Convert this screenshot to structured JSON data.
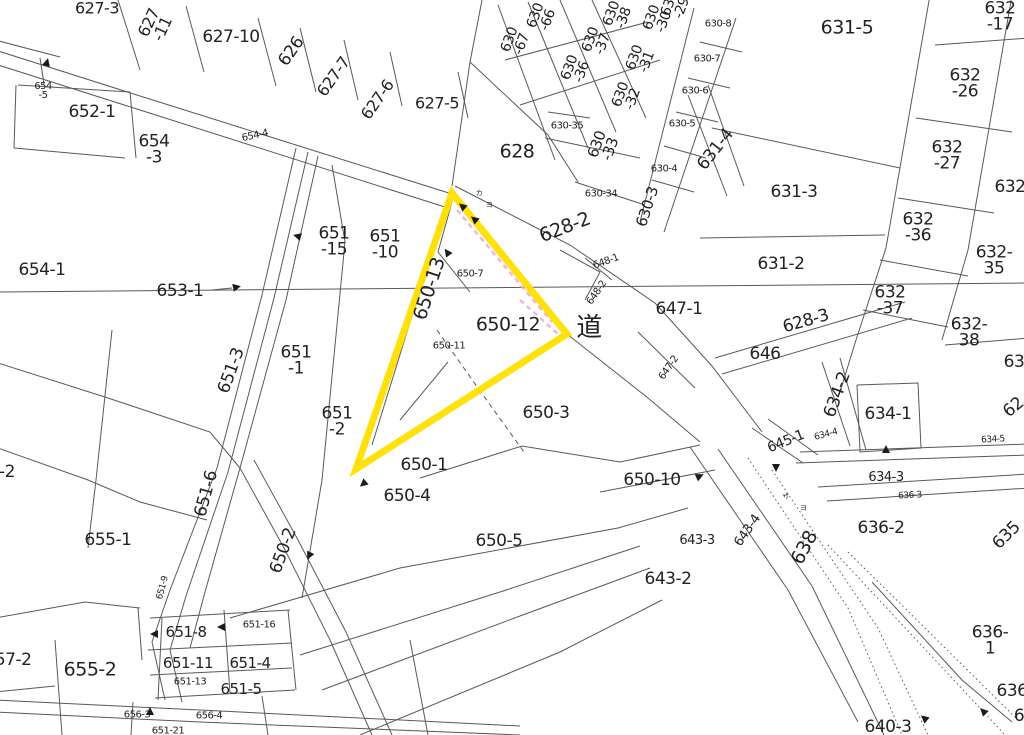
{
  "map": {
    "type": "japanese-cadastral-map",
    "road_kanji": "道",
    "highlight": {
      "shape": "triangle",
      "vertices": [
        [
          452,
          193
        ],
        [
          567,
          334
        ],
        [
          356,
          469
        ]
      ],
      "highlighted_parcels": [
        "650-13",
        "650-12"
      ]
    },
    "colors": {
      "background": "#ffffff",
      "line": "#595959",
      "text": "#222222",
      "highlight_yellow": "#ffdf00",
      "pink": "#f2a4d8"
    }
  },
  "labels": [
    {
      "t": "627-3",
      "x": 97,
      "y": 9,
      "r": 0,
      "s": 16
    },
    {
      "t": "627\n-11",
      "x": 156,
      "y": 26,
      "r": -65,
      "s": 16
    },
    {
      "t": "627-10",
      "x": 231,
      "y": 38,
      "r": 0,
      "s": 17
    },
    {
      "t": "626",
      "x": 292,
      "y": 52,
      "r": -55,
      "s": 17
    },
    {
      "t": "627-7",
      "x": 334,
      "y": 77,
      "r": -55,
      "s": 16
    },
    {
      "t": "627-6",
      "x": 378,
      "y": 100,
      "r": -55,
      "s": 16
    },
    {
      "t": "627-5",
      "x": 437,
      "y": 104,
      "r": 0,
      "s": 16
    },
    {
      "t": "654\n-5",
      "x": 43,
      "y": 91,
      "r": 0,
      "s": 10
    },
    {
      "t": "652-1",
      "x": 92,
      "y": 113,
      "r": 0,
      "s": 17
    },
    {
      "t": "654\n-3",
      "x": 154,
      "y": 150,
      "r": 0,
      "s": 17
    },
    {
      "t": "654-4",
      "x": 255,
      "y": 136,
      "r": -12,
      "s": 10
    },
    {
      "t": "654-1",
      "x": 42,
      "y": 271,
      "r": 0,
      "s": 17
    },
    {
      "t": "653-1",
      "x": 180,
      "y": 292,
      "r": 0,
      "s": 17
    },
    {
      "t": "630\n-67",
      "x": 516,
      "y": 42,
      "r": -70,
      "s": 14
    },
    {
      "t": "630\n-66",
      "x": 542,
      "y": 18,
      "r": -70,
      "s": 14
    },
    {
      "t": "630\n-36",
      "x": 576,
      "y": 70,
      "r": -70,
      "s": 14
    },
    {
      "t": "630\n-37",
      "x": 597,
      "y": 42,
      "r": -70,
      "s": 14
    },
    {
      "t": "630\n-38",
      "x": 618,
      "y": 16,
      "r": -70,
      "s": 14
    },
    {
      "t": "630\n-32",
      "x": 627,
      "y": 97,
      "r": -70,
      "s": 14
    },
    {
      "t": "630\n-31",
      "x": 641,
      "y": 60,
      "r": -70,
      "s": 14
    },
    {
      "t": "630\n-30",
      "x": 658,
      "y": 20,
      "r": -70,
      "s": 14
    },
    {
      "t": "630\n-29",
      "x": 676,
      "y": 6,
      "r": -70,
      "s": 14
    },
    {
      "t": "630-35",
      "x": 567,
      "y": 126,
      "r": 0,
      "s": 10
    },
    {
      "t": "630\n-33",
      "x": 604,
      "y": 147,
      "r": -70,
      "s": 15
    },
    {
      "t": "630-34",
      "x": 601,
      "y": 194,
      "r": 0,
      "s": 10
    },
    {
      "t": "630-3",
      "x": 648,
      "y": 207,
      "r": -72,
      "s": 15
    },
    {
      "t": "630-4",
      "x": 664,
      "y": 169,
      "r": 0,
      "s": 10
    },
    {
      "t": "630-5",
      "x": 682,
      "y": 124,
      "r": 0,
      "s": 10
    },
    {
      "t": "630-6",
      "x": 695,
      "y": 91,
      "r": 0,
      "s": 10
    },
    {
      "t": "630-7",
      "x": 707,
      "y": 59,
      "r": 0,
      "s": 10
    },
    {
      "t": "630-8",
      "x": 718,
      "y": 24,
      "r": 0,
      "s": 10
    },
    {
      "t": "628",
      "x": 517,
      "y": 152,
      "r": 0,
      "s": 19
    },
    {
      "t": "631-4",
      "x": 716,
      "y": 150,
      "r": -52,
      "s": 17
    },
    {
      "t": "631-5",
      "x": 847,
      "y": 28,
      "r": 0,
      "s": 19
    },
    {
      "t": "631-3",
      "x": 794,
      "y": 193,
      "r": 0,
      "s": 17
    },
    {
      "t": "631-2",
      "x": 781,
      "y": 265,
      "r": 0,
      "s": 17
    },
    {
      "t": "632\n-17",
      "x": 1000,
      "y": 17,
      "r": 0,
      "s": 17
    },
    {
      "t": "632\n-26",
      "x": 965,
      "y": 84,
      "r": 0,
      "s": 17
    },
    {
      "t": "632\n-27",
      "x": 947,
      "y": 156,
      "r": 0,
      "s": 17
    },
    {
      "t": "632",
      "x": 1010,
      "y": 188,
      "r": 0,
      "s": 17
    },
    {
      "t": "632\n-36",
      "x": 918,
      "y": 228,
      "r": 0,
      "s": 17
    },
    {
      "t": "632-35",
      "x": 994,
      "y": 261,
      "r": 0,
      "s": 17
    },
    {
      "t": "632\n-37",
      "x": 890,
      "y": 301,
      "r": 0,
      "s": 17
    },
    {
      "t": "632-38",
      "x": 969,
      "y": 333,
      "r": 0,
      "s": 17
    },
    {
      "t": "628-2",
      "x": 565,
      "y": 228,
      "r": -21,
      "s": 19
    },
    {
      "t": "648-1",
      "x": 606,
      "y": 262,
      "r": -20,
      "s": 10
    },
    {
      "t": "648-2",
      "x": 597,
      "y": 293,
      "r": -55,
      "s": 10
    },
    {
      "t": "道",
      "x": 589,
      "y": 329,
      "r": 0,
      "s": 26
    },
    {
      "t": "647-1",
      "x": 679,
      "y": 310,
      "r": 0,
      "s": 17
    },
    {
      "t": "647-2",
      "x": 669,
      "y": 368,
      "r": -55,
      "s": 10
    },
    {
      "t": "646",
      "x": 765,
      "y": 355,
      "r": 0,
      "s": 17
    },
    {
      "t": "628-3",
      "x": 806,
      "y": 322,
      "r": -16,
      "s": 17
    },
    {
      "t": "634-2",
      "x": 838,
      "y": 395,
      "r": -70,
      "s": 17
    },
    {
      "t": "634-1",
      "x": 888,
      "y": 415,
      "r": 0,
      "s": 17
    },
    {
      "t": "634-4",
      "x": 826,
      "y": 435,
      "r": -15,
      "s": 9
    },
    {
      "t": "634-5",
      "x": 993,
      "y": 440,
      "r": -3,
      "s": 9
    },
    {
      "t": "634-3",
      "x": 886,
      "y": 478,
      "r": 0,
      "s": 13
    },
    {
      "t": "636-3",
      "x": 910,
      "y": 496,
      "r": -3,
      "s": 9
    },
    {
      "t": "636-2",
      "x": 881,
      "y": 529,
      "r": 0,
      "s": 17
    },
    {
      "t": "635",
      "x": 1007,
      "y": 536,
      "r": -45,
      "s": 17
    },
    {
      "t": "63",
      "x": 1014,
      "y": 363,
      "r": 0,
      "s": 17
    },
    {
      "t": "62",
      "x": 1014,
      "y": 408,
      "r": -40,
      "s": 17
    },
    {
      "t": "645-1",
      "x": 786,
      "y": 442,
      "r": -22,
      "s": 14
    },
    {
      "t": "650-10",
      "x": 652,
      "y": 481,
      "r": 0,
      "s": 17
    },
    {
      "t": "643-4",
      "x": 748,
      "y": 531,
      "r": -55,
      "s": 13
    },
    {
      "t": "638",
      "x": 805,
      "y": 548,
      "r": -62,
      "s": 19
    },
    {
      "t": "643-3",
      "x": 697,
      "y": 541,
      "r": 0,
      "s": 13
    },
    {
      "t": "643-2",
      "x": 668,
      "y": 580,
      "r": 0,
      "s": 17
    },
    {
      "t": "636-1",
      "x": 990,
      "y": 641,
      "r": 0,
      "s": 17
    },
    {
      "t": "636",
      "x": 1012,
      "y": 692,
      "r": 0,
      "s": 17
    },
    {
      "t": "6",
      "x": 1019,
      "y": 717,
      "r": 0,
      "s": 17
    },
    {
      "t": "640-3",
      "x": 888,
      "y": 728,
      "r": 0,
      "s": 17
    },
    {
      "t": "651\n-15",
      "x": 334,
      "y": 242,
      "r": 0,
      "s": 17
    },
    {
      "t": "651\n-10",
      "x": 385,
      "y": 245,
      "r": 0,
      "s": 17
    },
    {
      "t": "650-13",
      "x": 430,
      "y": 289,
      "r": -72,
      "s": 19
    },
    {
      "t": "650-7",
      "x": 470,
      "y": 274,
      "r": 0,
      "s": 10
    },
    {
      "t": "650-12",
      "x": 508,
      "y": 325,
      "r": 0,
      "s": 19
    },
    {
      "t": "650-11",
      "x": 449,
      "y": 346,
      "r": 0,
      "s": 10
    },
    {
      "t": "651\n-1",
      "x": 296,
      "y": 361,
      "r": 0,
      "s": 17
    },
    {
      "t": "651-3",
      "x": 232,
      "y": 371,
      "r": -70,
      "s": 17
    },
    {
      "t": "651\n-2",
      "x": 337,
      "y": 422,
      "r": 0,
      "s": 17
    },
    {
      "t": "650-1",
      "x": 424,
      "y": 466,
      "r": 0,
      "s": 17
    },
    {
      "t": "650-4",
      "x": 407,
      "y": 497,
      "r": 0,
      "s": 17
    },
    {
      "t": "650-3",
      "x": 546,
      "y": 414,
      "r": 0,
      "s": 17
    },
    {
      "t": "650-5",
      "x": 499,
      "y": 542,
      "r": 0,
      "s": 17
    },
    {
      "t": "651-6",
      "x": 207,
      "y": 494,
      "r": -75,
      "s": 17
    },
    {
      "t": "650-2",
      "x": 284,
      "y": 551,
      "r": -70,
      "s": 17
    },
    {
      "t": "651-9",
      "x": 163,
      "y": 588,
      "r": -75,
      "s": 9
    },
    {
      "t": "655-1",
      "x": 108,
      "y": 541,
      "r": 0,
      "s": 17
    },
    {
      "t": "-2",
      "x": 7,
      "y": 473,
      "r": 0,
      "s": 17
    },
    {
      "t": "655-2",
      "x": 90,
      "y": 670,
      "r": 0,
      "s": 19
    },
    {
      "t": "657-2",
      "x": 8,
      "y": 661,
      "r": 0,
      "s": 17
    },
    {
      "t": "651-8",
      "x": 186,
      "y": 633,
      "r": 0,
      "s": 15
    },
    {
      "t": "651-16",
      "x": 259,
      "y": 625,
      "r": 0,
      "s": 10
    },
    {
      "t": "651-11",
      "x": 188,
      "y": 664,
      "r": 0,
      "s": 15
    },
    {
      "t": "651-4",
      "x": 250,
      "y": 664,
      "r": 0,
      "s": 15
    },
    {
      "t": "651-13",
      "x": 190,
      "y": 682,
      "r": 0,
      "s": 10
    },
    {
      "t": "651-5",
      "x": 241,
      "y": 690,
      "r": 0,
      "s": 15
    },
    {
      "t": "656-3",
      "x": 137,
      "y": 715,
      "r": 0,
      "s": 10
    },
    {
      "t": "656-4",
      "x": 209,
      "y": 716,
      "r": 0,
      "s": 10
    },
    {
      "t": "651-21",
      "x": 168,
      "y": 731,
      "r": 0,
      "s": 10
    },
    {
      "t": "カ",
      "x": 479,
      "y": 193,
      "r": 0,
      "s": 7
    },
    {
      "t": "ヨ",
      "x": 489,
      "y": 205,
      "r": 0,
      "s": 7
    },
    {
      "t": "サ",
      "x": 786,
      "y": 497,
      "r": -20,
      "s": 7
    },
    {
      "t": "ヨ",
      "x": 803,
      "y": 508,
      "r": 0,
      "s": 7
    }
  ],
  "arrows": [
    {
      "x": 47,
      "y": 62,
      "a": -75
    },
    {
      "x": 297,
      "y": 236,
      "a": 195
    },
    {
      "x": 237,
      "y": 287,
      "a": -12
    },
    {
      "x": 462,
      "y": 206,
      "a": -140
    },
    {
      "x": 474,
      "y": 219,
      "a": -140
    },
    {
      "x": 447,
      "y": 252,
      "a": -125
    },
    {
      "x": 363,
      "y": 484,
      "a": 140
    },
    {
      "x": 309,
      "y": 556,
      "a": 115
    },
    {
      "x": 700,
      "y": 476,
      "a": -25
    },
    {
      "x": 776,
      "y": 468,
      "a": 90
    },
    {
      "x": 886,
      "y": 449,
      "a": -90
    },
    {
      "x": 154,
      "y": 634,
      "a": 180
    },
    {
      "x": 221,
      "y": 627,
      "a": 180
    },
    {
      "x": 150,
      "y": 711,
      "a": -90
    },
    {
      "x": 924,
      "y": 718,
      "a": -140
    },
    {
      "x": 983,
      "y": 711,
      "a": -135
    }
  ]
}
